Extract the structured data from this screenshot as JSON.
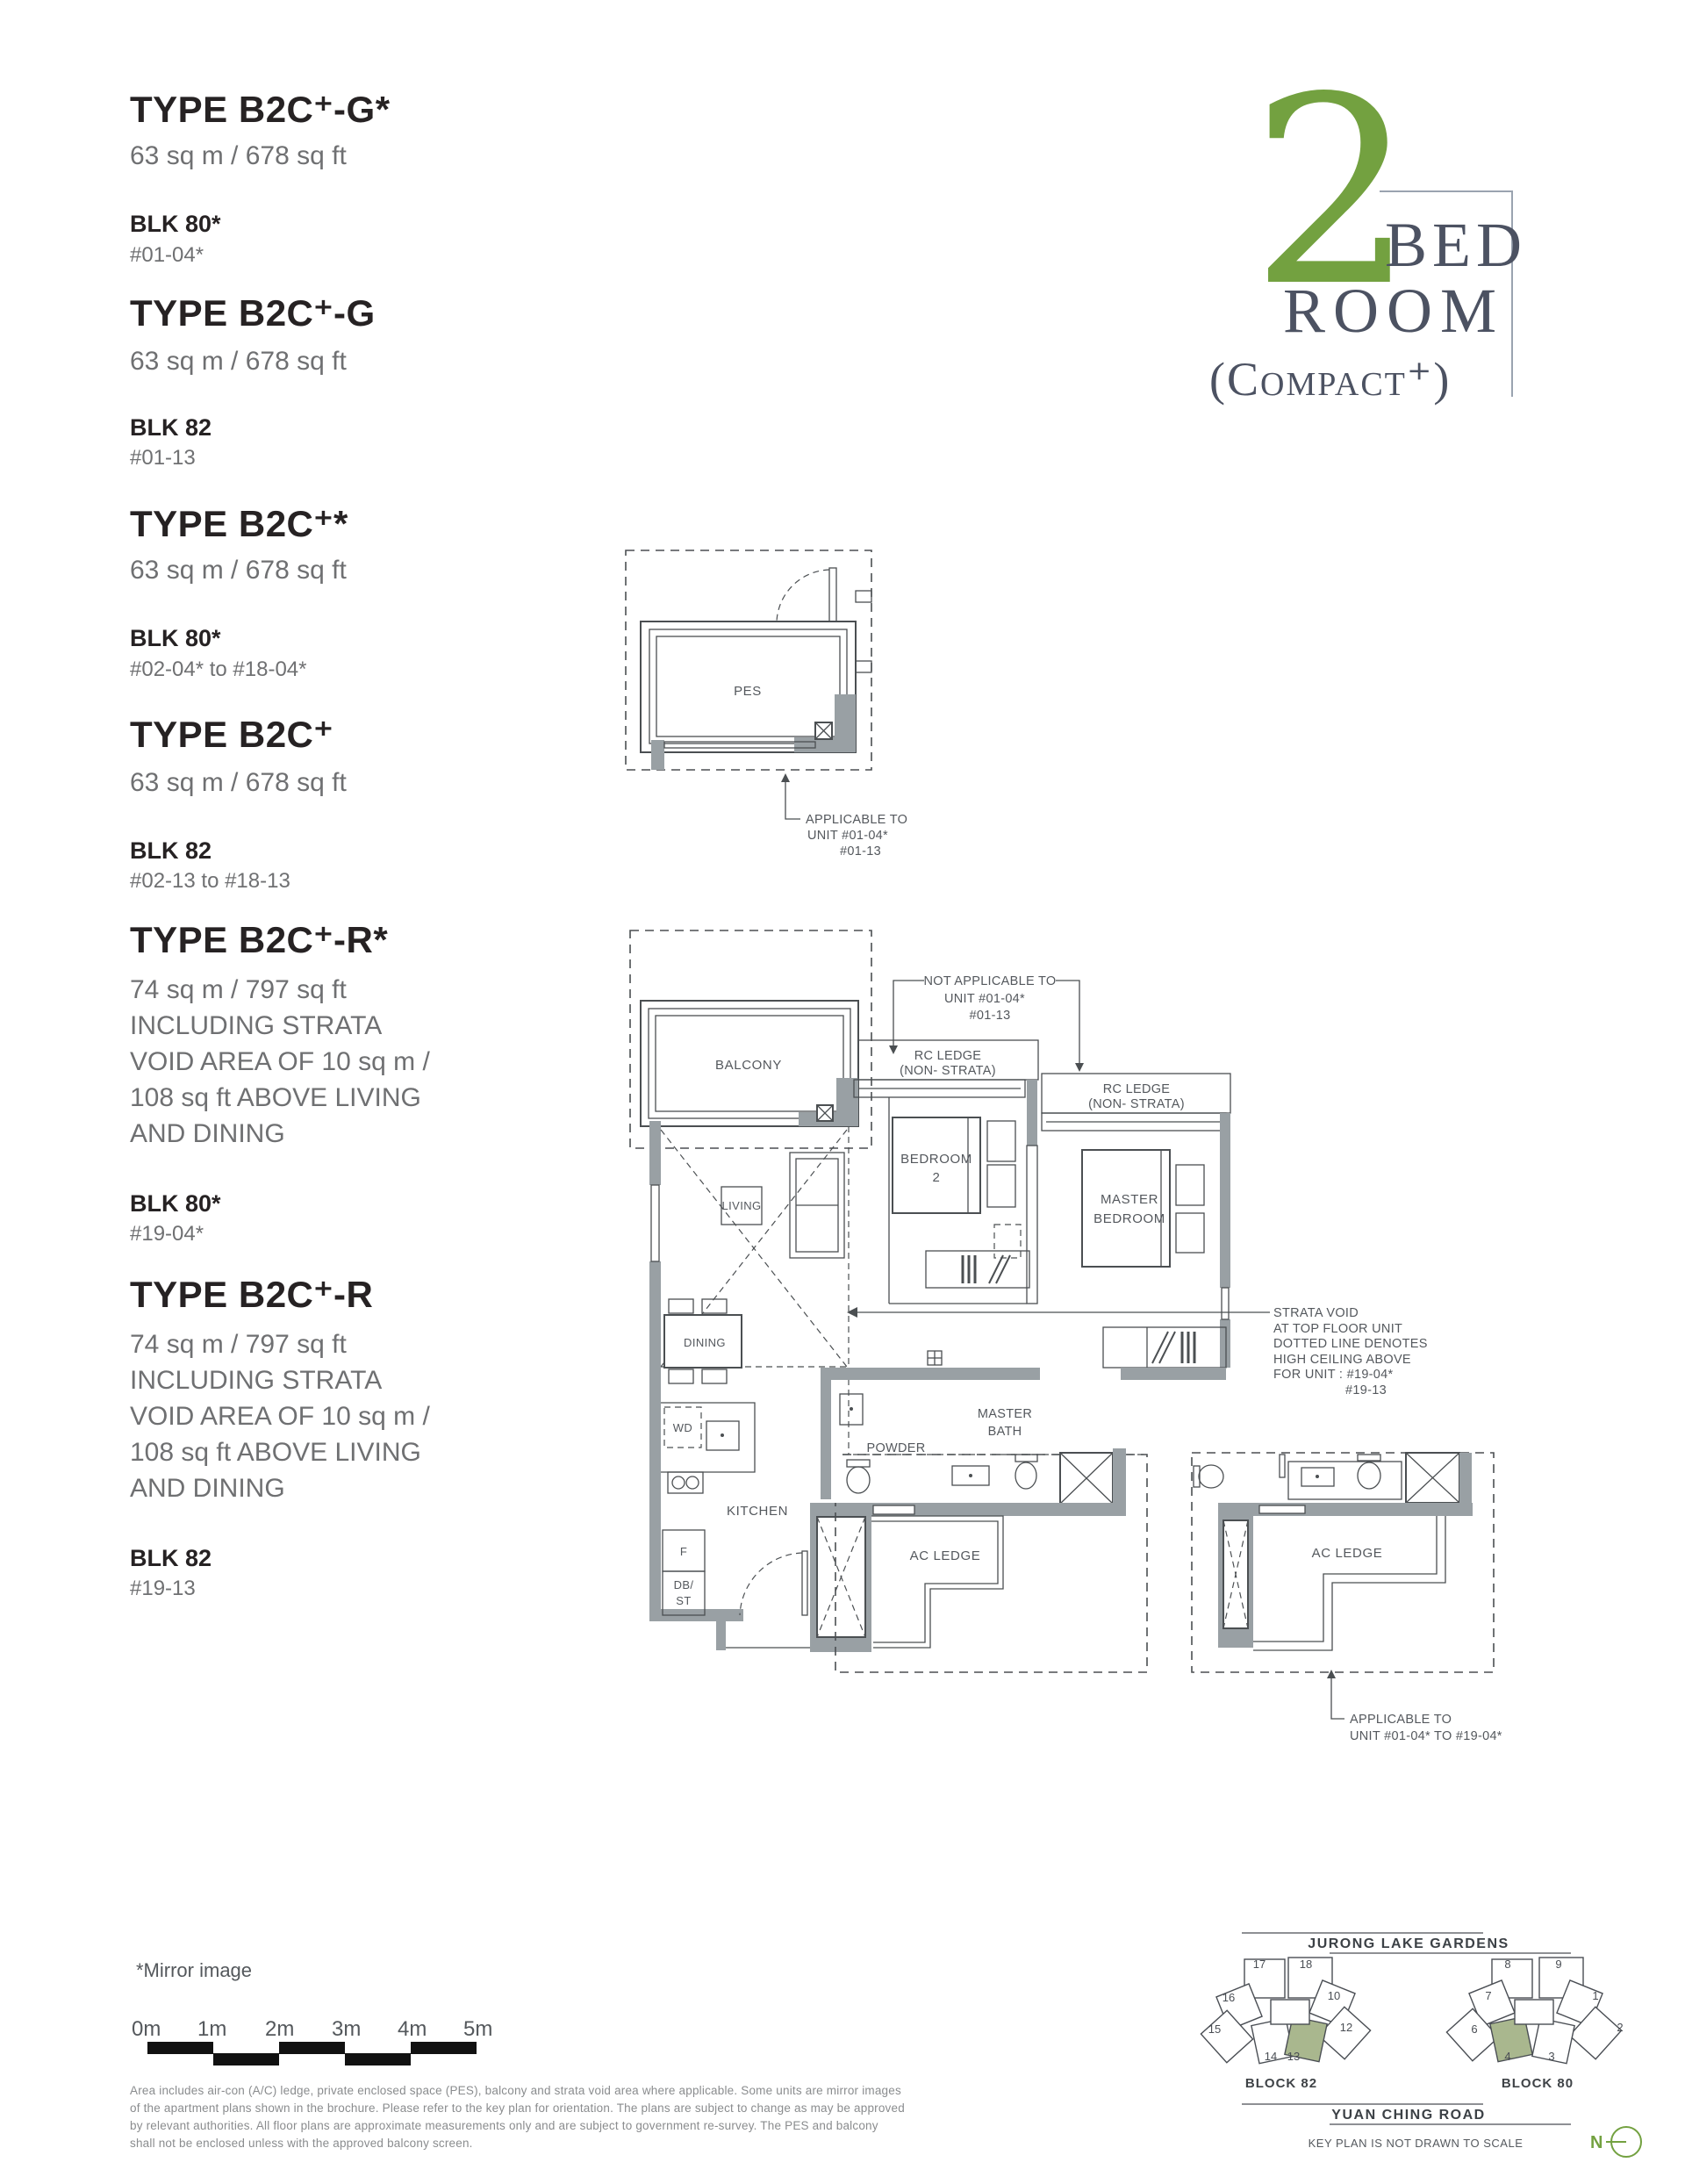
{
  "header": {
    "number": "2",
    "word1": "BED",
    "word2": "ROOM",
    "word3": "(Compact⁺)"
  },
  "types": [
    {
      "name": "TYPE B2C⁺-G*",
      "area_lines": [
        "63 sq m / 678 sq ft"
      ],
      "blk": "BLK 80*",
      "units": "#01-04*"
    },
    {
      "name": "TYPE B2C⁺-G",
      "area_lines": [
        "63 sq m / 678 sq ft"
      ],
      "blk": "BLK 82",
      "units": "#01-13"
    },
    {
      "name": "TYPE B2C⁺*",
      "area_lines": [
        "63 sq m / 678 sq ft"
      ],
      "blk": "BLK 80*",
      "units": "#02-04* to #18-04*"
    },
    {
      "name": "TYPE B2C⁺",
      "area_lines": [
        "63 sq m / 678 sq ft"
      ],
      "blk": "BLK 82",
      "units": "#02-13 to #18-13"
    },
    {
      "name": "TYPE B2C⁺-R*",
      "area_lines": [
        "74 sq m / 797 sq ft",
        "INCLUDING STRATA",
        "VOID AREA OF 10 sq m /",
        "108 sq ft ABOVE LIVING",
        "AND DINING"
      ],
      "blk": "BLK 80*",
      "units": "#19-04*"
    },
    {
      "name": "TYPE B2C⁺-R",
      "area_lines": [
        "74 sq m / 797 sq ft",
        "INCLUDING STRATA",
        "VOID AREA OF 10 sq m /",
        "108 sq ft ABOVE LIVING",
        "AND DINING"
      ],
      "blk": "BLK 82",
      "units": "#19-13"
    }
  ],
  "pes_plan": {
    "room": "PES",
    "note1": "APPLICABLE TO",
    "note2": "UNIT #01-04*",
    "note3": "#01-13"
  },
  "main_plan": {
    "balcony": "BALCONY",
    "living": "LIVING",
    "dining": "DINING",
    "kitchen": "KITCHEN",
    "bedroom2_l1": "BEDROOM",
    "bedroom2_l2": "2",
    "master_l1": "MASTER",
    "master_l2": "BEDROOM",
    "bath_l1": "MASTER",
    "bath_l2": "BATH",
    "powder": "POWDER",
    "wd": "WD",
    "f": "F",
    "db": "DB/",
    "st": "ST",
    "ac_ledge": "AC LEDGE",
    "rc1_l1": "RC LEDGE",
    "rc1_l2": "(NON- STRATA)",
    "rc2_l1": "RC LEDGE",
    "rc2_l2": "(NON- STRATA)",
    "na1": "NOT APPLICABLE TO",
    "na2": "UNIT #01-04*",
    "na3": "#01-13",
    "strata1": "STRATA VOID",
    "strata2": "AT TOP FLOOR UNIT",
    "strata3": "DOTTED LINE DENOTES",
    "strata4": "HIGH CEILING ABOVE",
    "strata5": "FOR UNIT : #19-04*",
    "strata6": "#19-13"
  },
  "right_plan": {
    "ac_ledge": "AC LEDGE",
    "note1": "APPLICABLE TO",
    "note2": "UNIT #01-04* TO #19-04*"
  },
  "scale": {
    "mirror_note": "*Mirror image",
    "labels": [
      "0m",
      "1m",
      "2m",
      "3m",
      "4m",
      "5m"
    ]
  },
  "disclaimer": {
    "line1": "Area includes air-con (A/C) ledge, private enclosed space (PES), balcony and strata void area where applicable. Some units are mirror images",
    "line2": "of the apartment plans shown in the brochure. Please refer to the key plan for orientation. The plans are subject to change as may be approved",
    "line3": "by relevant authorities. All floor plans are approximate measurements only and are subject to government re-survey. The PES and balcony",
    "line4": "shall not be enclosed unless with the approved balcony screen."
  },
  "keyplan": {
    "garden": "JURONG LAKE GARDENS",
    "road": "YUAN CHING ROAD",
    "note": "KEY PLAN IS NOT DRAWN TO SCALE",
    "north": "N",
    "block82": {
      "label": "BLOCK 82",
      "units": [
        "17",
        "18",
        "16",
        "10",
        "15",
        "12",
        "14",
        "13"
      ]
    },
    "block80": {
      "label": "BLOCK 80",
      "units": [
        "8",
        "9",
        "7",
        "1",
        "6",
        "2",
        "4",
        "3"
      ]
    }
  },
  "colors": {
    "green": "#73a140",
    "sage": "#a9b78e",
    "title_text": "#4c5262",
    "wall": "#99a0a4"
  }
}
